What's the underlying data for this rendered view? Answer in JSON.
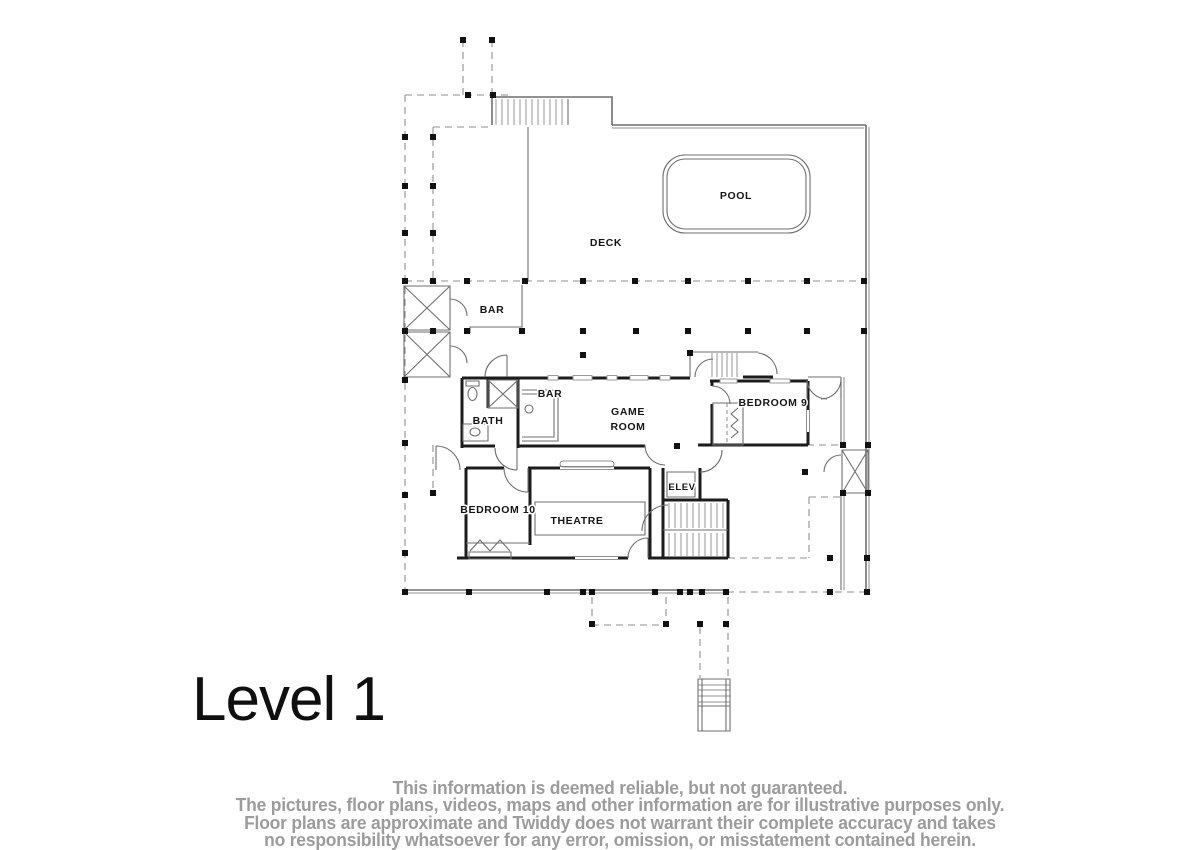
{
  "page": {
    "background": "#ffffff"
  },
  "floor_plan": {
    "level_label": "Level 1",
    "labels": {
      "pool": "POOL",
      "deck": "DECK",
      "outdoor_bar": "BAR",
      "bath": "BATH",
      "bar": "BAR",
      "game_room_line1": "GAME",
      "game_room_line2": "ROOM",
      "bedroom_9": "BEDROOM 9",
      "bedroom_10": "BEDROOM 10",
      "theatre": "THEATRE",
      "elevator": "ELEV"
    },
    "colors": {
      "wall": "#1c1c1c",
      "line": "#6f6f6f",
      "dashed_line": "#8f8f8f",
      "label_text": "#151515",
      "level_text": "#0f0f0f"
    }
  },
  "disclaimer": {
    "color": "#9c9c9c",
    "lines": [
      "This information is deemed reliable, but not guaranteed.",
      "The pictures, floor plans, videos, maps and other information are for illustrative purposes only.",
      "Floor plans are approximate and Twiddy does not warrant their complete accuracy and takes",
      "no responsibility whatsoever for any error, omission, or misstatement contained herein."
    ]
  }
}
